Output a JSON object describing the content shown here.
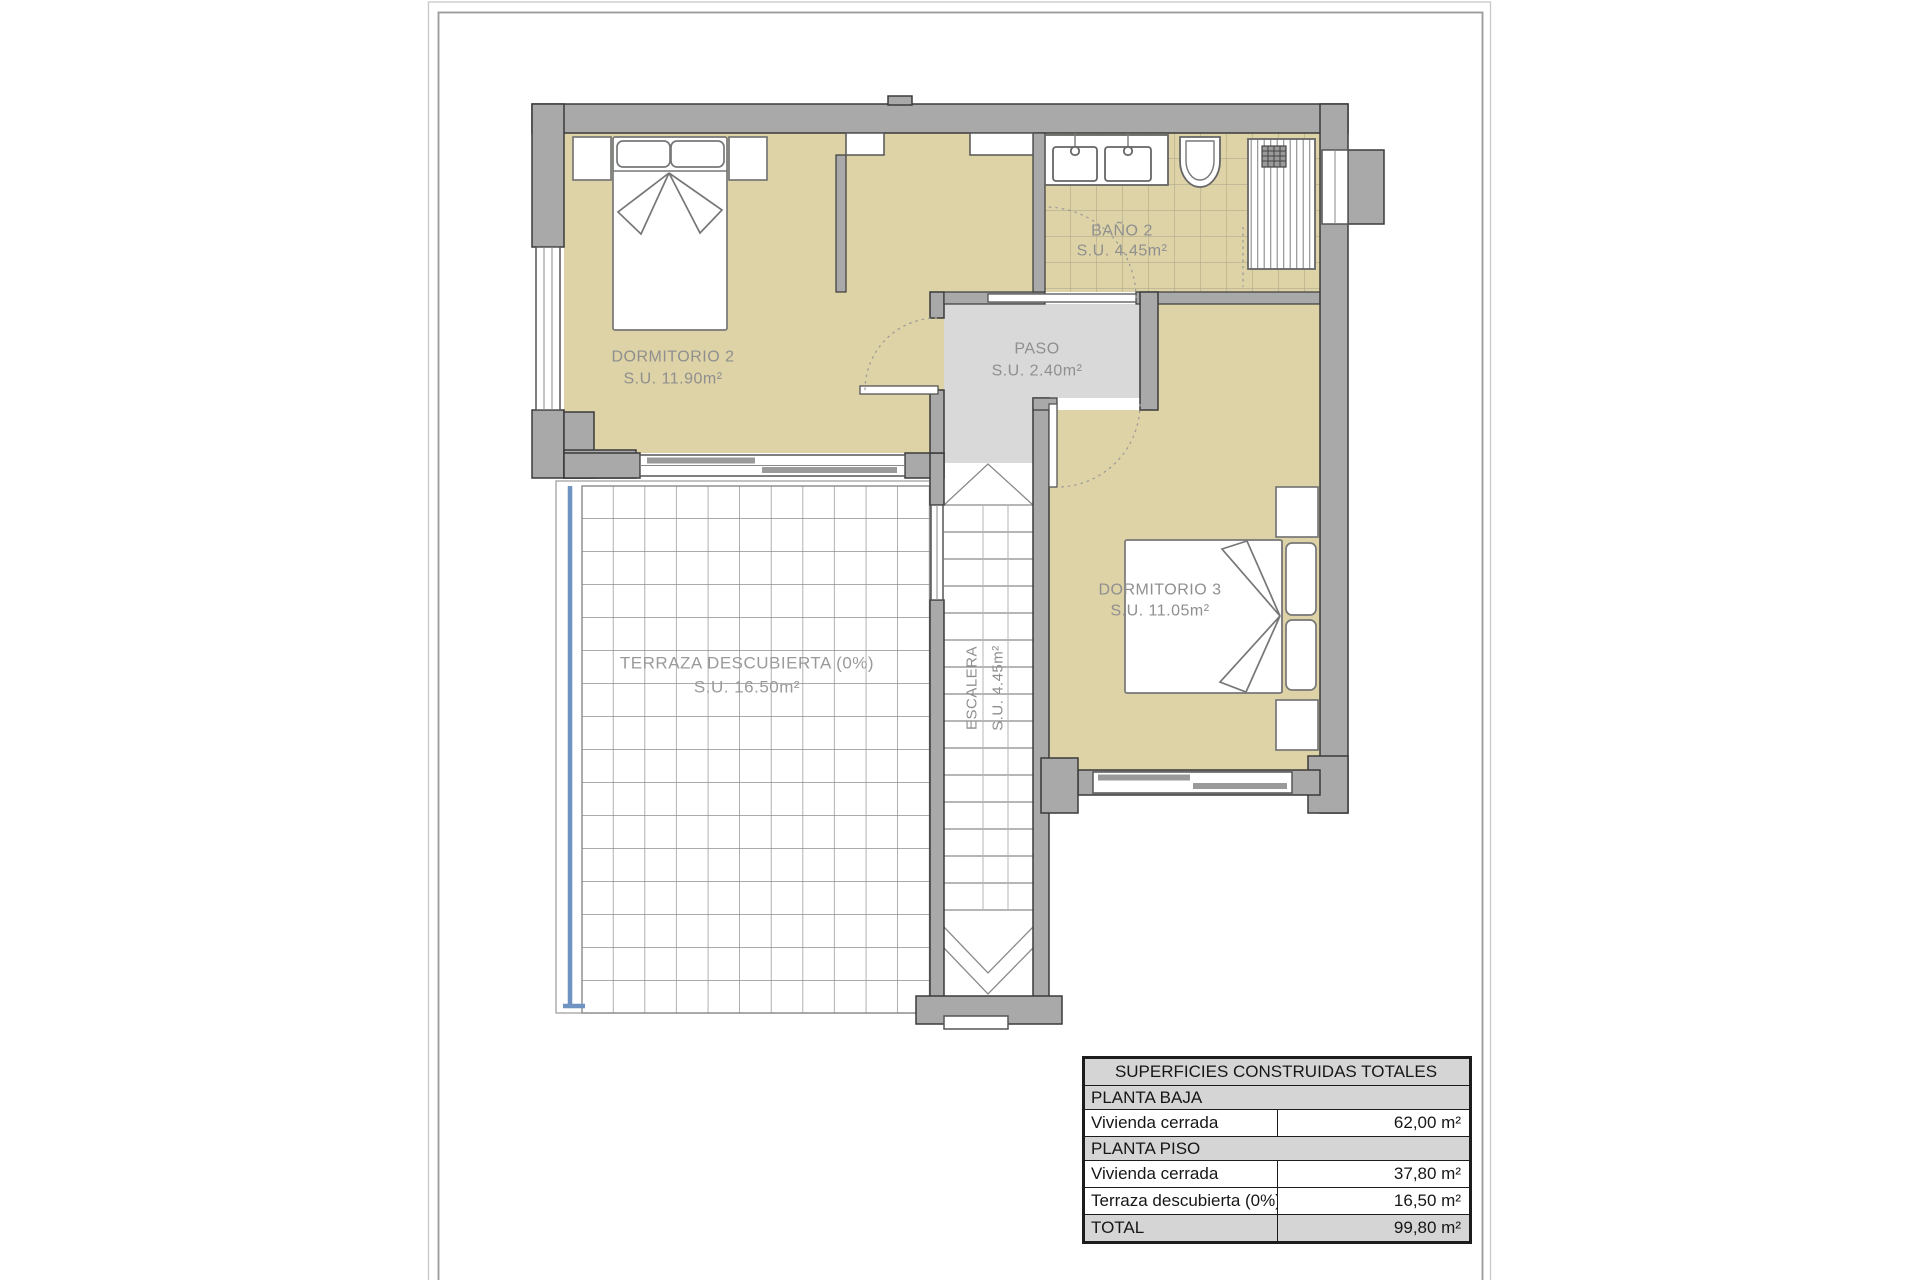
{
  "sheet": {
    "type": "floor-plan-drawing",
    "floor": "PLANTA PISO"
  },
  "colors": {
    "wall_fill": "#a9a9a9",
    "wall_stroke": "#3a3a3a",
    "room_floor_beige": "#ded3a6",
    "bath_tile_line": "#b2aa8c",
    "paso_floor_gray": "#d9d9d9",
    "terrace_grid_line": "#8f8f8f",
    "terrace_edge_blue": "#6f94c4",
    "label_gray": "#8f8f8f",
    "table_header_bg": "#d5d5d5",
    "table_border": "#1c1c1c"
  },
  "rooms": {
    "dormitorio2": {
      "name": "DORMITORIO 2",
      "area": "S.U. 11.90m²"
    },
    "bano2": {
      "name": "BAÑO 2",
      "area": "S.U. 4.45m²"
    },
    "paso": {
      "name": "PASO",
      "area": "S.U. 2.40m²"
    },
    "dormitorio3": {
      "name": "DORMITORIO 3",
      "area": "S.U. 11.05m²"
    },
    "terraza": {
      "name": "TERRAZA DESCUBIERTA (0%)",
      "area": "S.U. 16.50m²"
    },
    "escalera": {
      "name": "ESCALERA",
      "area": "S.U. 4.45m²"
    }
  },
  "summary_table": {
    "title": "SUPERFICIES CONSTRUIDAS TOTALES",
    "rows": [
      {
        "label": "PLANTA BAJA",
        "value": ""
      },
      {
        "label": "Vivienda cerrada",
        "value": "62,00 m²"
      },
      {
        "label": "PLANTA PISO",
        "value": ""
      },
      {
        "label": "Vivienda cerrada",
        "value": "37,80 m²"
      },
      {
        "label": "Terraza descubierta (0%)",
        "value": "16,50 m²"
      },
      {
        "label": "TOTAL",
        "value": "99,80 m²"
      }
    ]
  }
}
